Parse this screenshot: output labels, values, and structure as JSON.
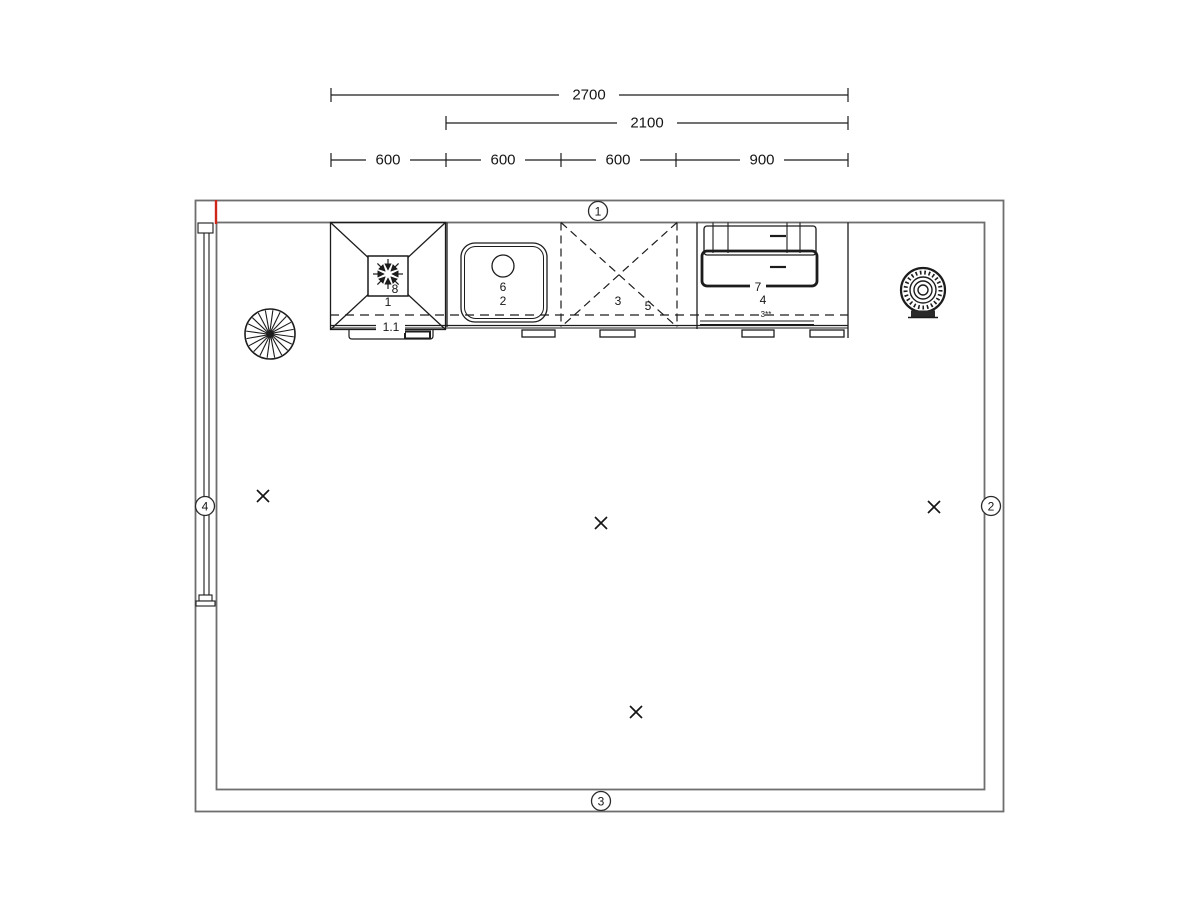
{
  "drawing": {
    "type": "kitchen-floor-plan",
    "colors": {
      "line": "#1c1c1c",
      "wall": "#6e6e6e",
      "red": "#cf261a",
      "bg": "#ffffff"
    },
    "dimensions": {
      "row1": {
        "value": "2700"
      },
      "row2": {
        "value": "2100"
      },
      "row3": {
        "segments": [
          "600",
          "600",
          "600",
          "900"
        ]
      }
    },
    "wall_markers": {
      "top": "1",
      "right": "2",
      "bottom": "3",
      "left": "4"
    },
    "units": {
      "freezer": {
        "id": "1",
        "symbol_id": "8",
        "plinth_id": "1.1",
        "icon": "snowflake-arrows-icon"
      },
      "sink": {
        "id": "2",
        "fixture_id": "6"
      },
      "hob": {
        "id": "3",
        "aux_id": "5"
      },
      "oven": {
        "id": "4",
        "drawer_id": "7",
        "connection": "3**"
      }
    },
    "symbols": {
      "fan": "radial-fan-icon",
      "boiler": "concentric-boiler-icon",
      "cross_marks": 4
    }
  }
}
